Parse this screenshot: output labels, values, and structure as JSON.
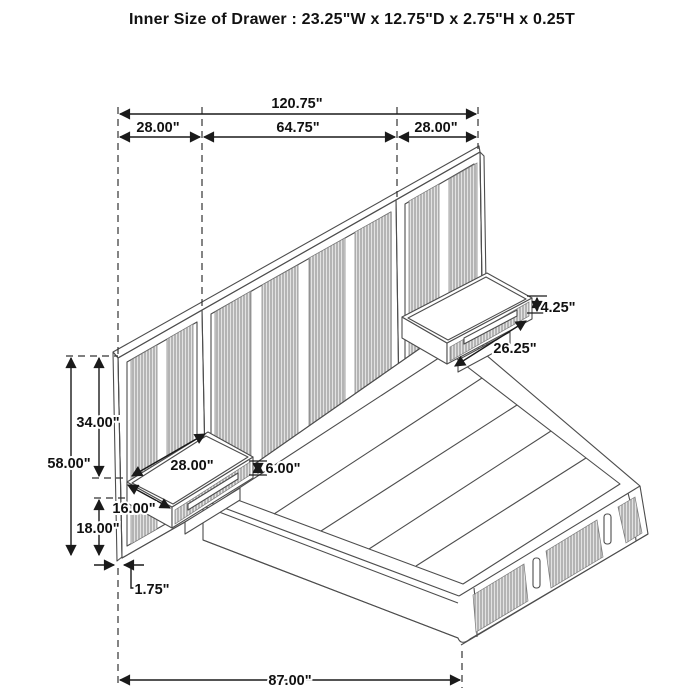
{
  "title": "Inner Size of Drawer : 23.25\"W x 12.75\"D x 2.75\"H x 0.25T",
  "dimension_labels": {
    "overall_width": "120.75\"",
    "left_section_width": "28.00\"",
    "center_section_width": "64.75\"",
    "right_section_width": "28.00\"",
    "right_nightstand_face_height": "4.25\"",
    "right_nightstand_width": "26.25\"",
    "headboard_upper_height": "34.00\"",
    "headboard_total_height": "58.00\"",
    "left_nightstand_width": "28.00\"",
    "left_nightstand_height": "6.00\"",
    "left_nightstand_depth": "16.00\"",
    "floor_clearance": "18.00\"",
    "panel_thickness": "1.75\"",
    "overall_depth": "87.00\""
  },
  "colors": {
    "outline": "#4d4d4d",
    "dimension": "#1a1a1a",
    "flute_base": "#e3e3e3",
    "flute_stripe": "#8d8d8d",
    "background": "#ffffff"
  }
}
